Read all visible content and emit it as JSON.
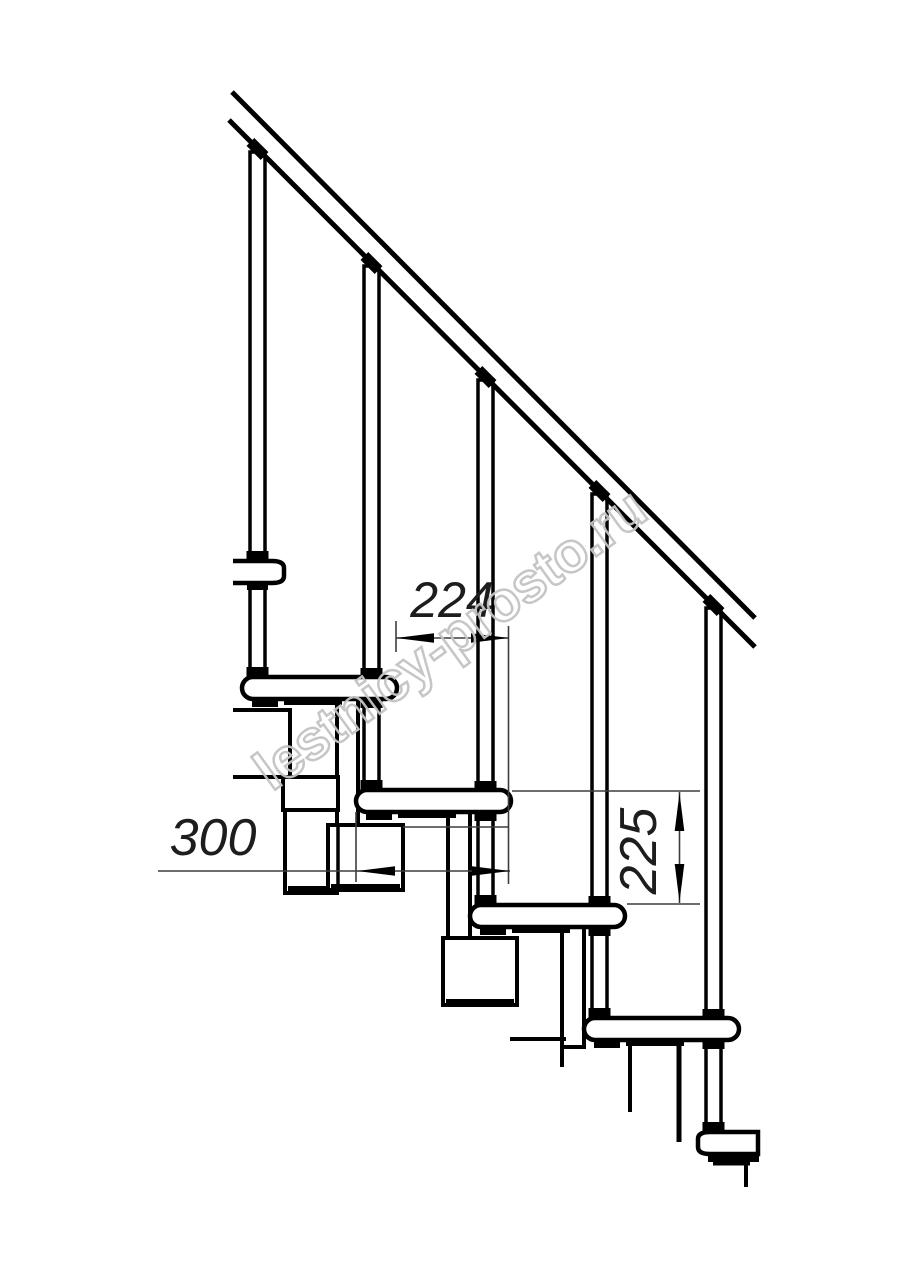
{
  "drawing": {
    "type": "modular-staircase-side-elevation",
    "watermark": "lestnicy-prosto.ru",
    "dimensions": {
      "step_offset": "224",
      "module_length": "300",
      "step_rise": "225"
    },
    "counts": {
      "balusters": 5,
      "treads": 5,
      "support_modules": 4
    }
  },
  "colors": {
    "background": "#ffffff",
    "line_color": "#000000",
    "dimension_line_color": "#3d3d3d",
    "watermark_color": "#c4c4c4"
  }
}
